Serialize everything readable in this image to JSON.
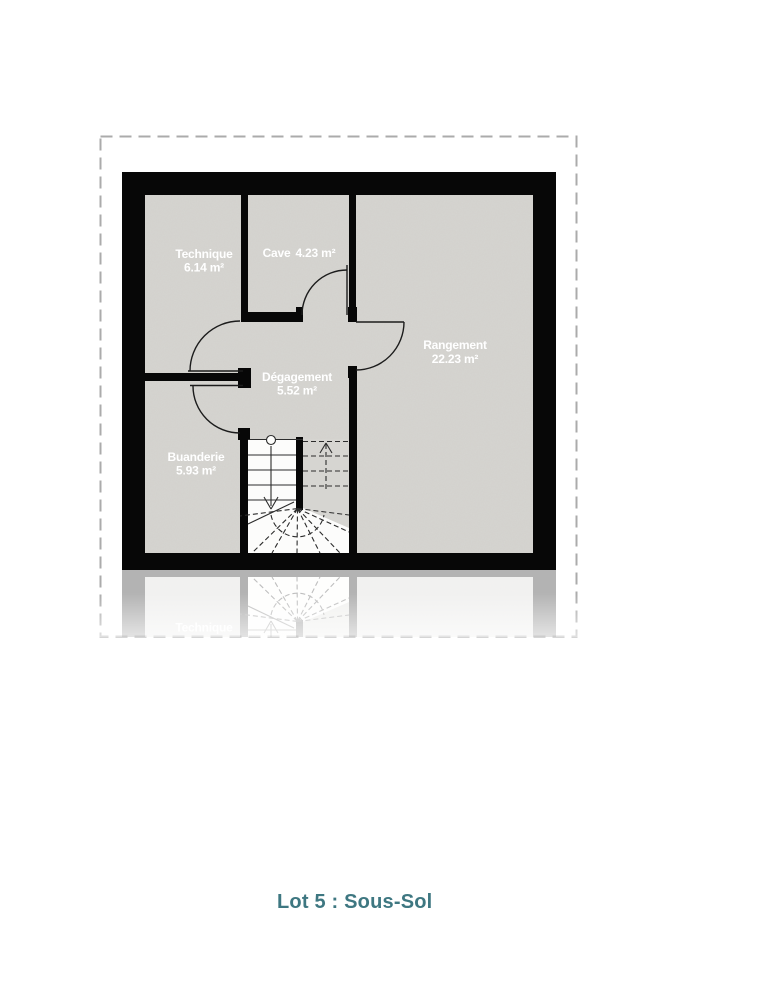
{
  "title": "Lot 5 : Sous-Sol",
  "plan": {
    "rooms": [
      {
        "name": "Technique",
        "area": "6.14 m²"
      },
      {
        "name": "Cave",
        "area": "4.23 m²"
      },
      {
        "name": "Dégagement",
        "area": "5.52 m²"
      },
      {
        "name": "Rangement",
        "area": "22.23 m²"
      },
      {
        "name": "Buanderie",
        "area": "5.93 m²"
      }
    ],
    "reflection_label": "Technique"
  },
  "colors": {
    "wall": "#070707",
    "room_fill": "#d6d5d1",
    "stair_fill": "#fcfcfb",
    "label_text": "#ffffff",
    "title_text": "#3e7781",
    "dashed_border": "#ababab"
  }
}
